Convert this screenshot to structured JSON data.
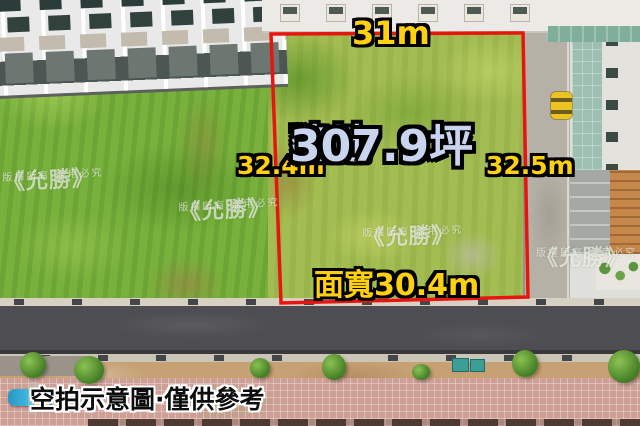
{
  "annotations": {
    "top_length": "31m",
    "left_length": "32.4m",
    "right_length": "32.5m",
    "area_label": "建地",
    "area_value": "307.9坪",
    "frontage": "面寬30.4m"
  },
  "watermark": {
    "brand": "《允勝》",
    "notice": "版權所有·盜用必究"
  },
  "caption": {
    "star": "★",
    "text": "空拍示意圖·僅供參考"
  },
  "colors": {
    "boundary_red": "#e6160e",
    "measure_yellow": "#ffd010",
    "area_text_blue": "#c9d5ee",
    "watermark_white": "rgba(255,255,255,0.62)"
  }
}
